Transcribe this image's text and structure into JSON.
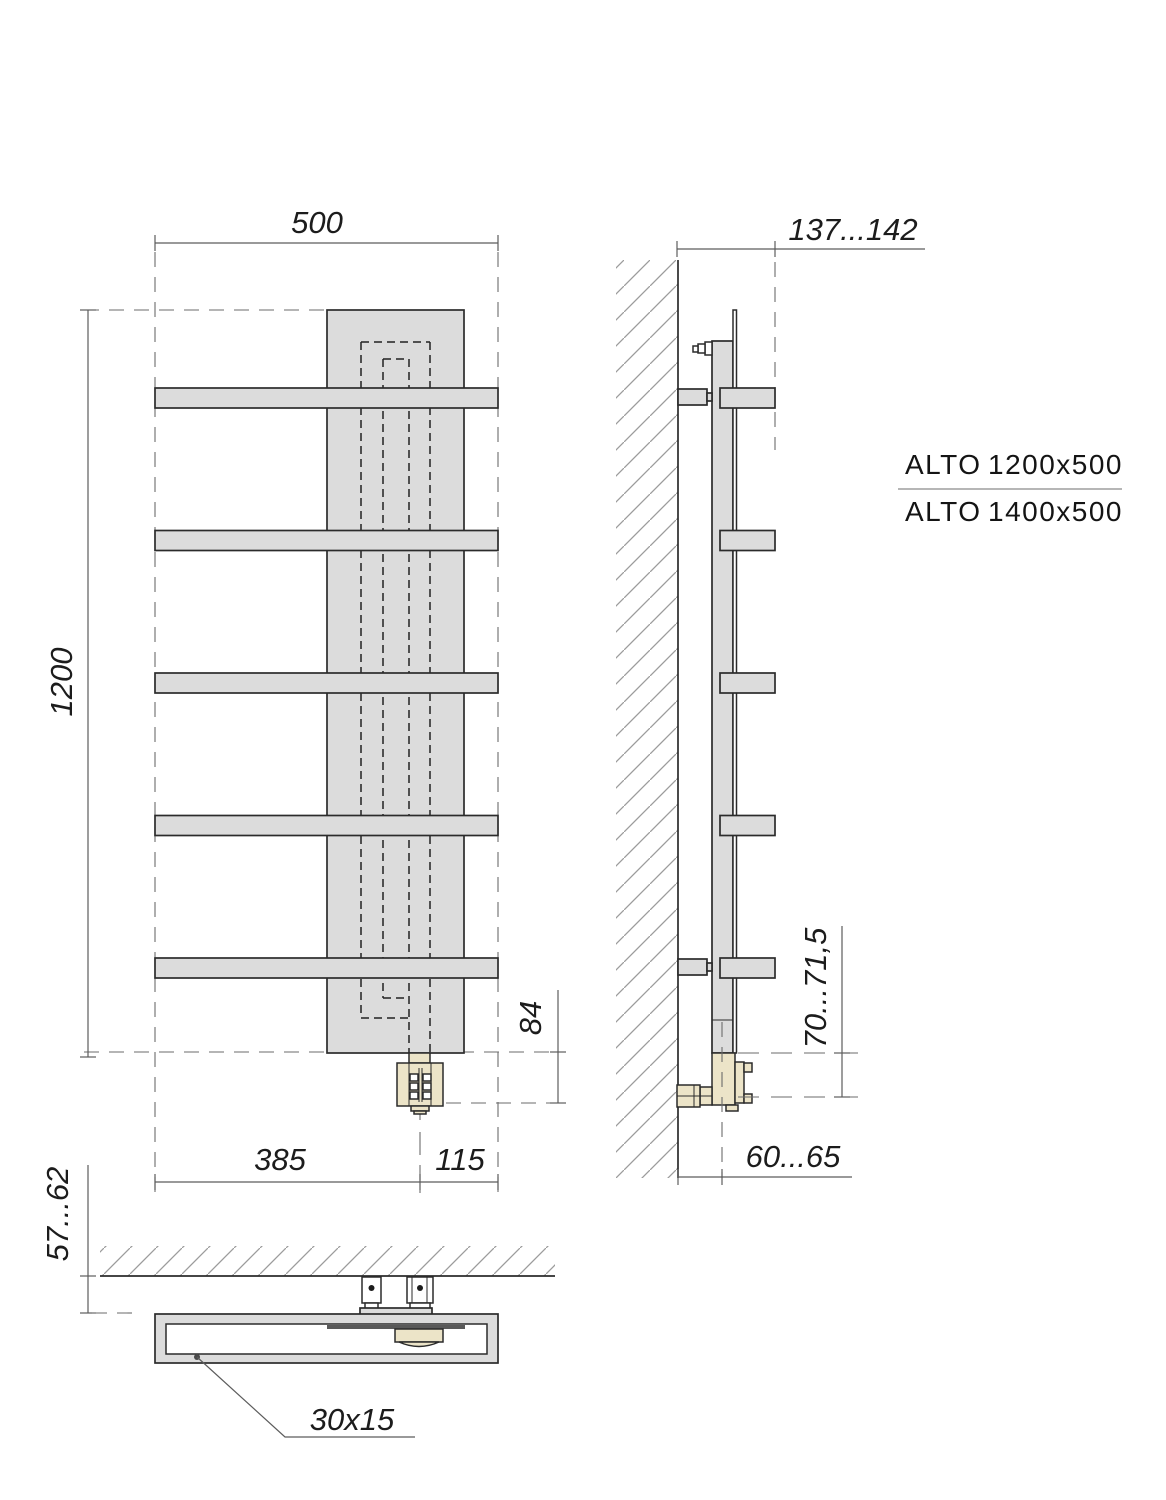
{
  "drawing": {
    "models": [
      {
        "name": "ALTO",
        "size": "1200x500"
      },
      {
        "name": "ALTO",
        "size": "1400x500"
      }
    ],
    "front_view": {
      "width": "500",
      "height": "1200",
      "offset_left": "385",
      "offset_right": "115",
      "connection_drop": "84"
    },
    "side_view": {
      "depth_range": "137...142",
      "connection_height_range": "70...71,5",
      "wall_axis_range": "60...65"
    },
    "top_view": {
      "wall_clearance_range": "57...62",
      "profile": "30x15"
    }
  }
}
